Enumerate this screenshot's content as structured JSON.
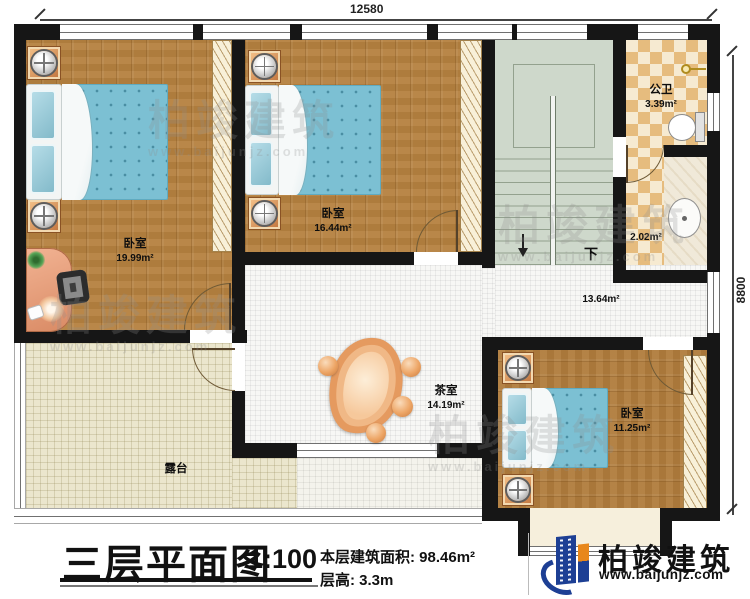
{
  "plan": {
    "dimensions": {
      "width_label": "12580",
      "height_label": "8800"
    },
    "rooms": {
      "bedroom1": {
        "name": "卧室",
        "area": "19.99m²"
      },
      "bedroom2": {
        "name": "卧室",
        "area": "16.44m²"
      },
      "bedroom3": {
        "name": "卧室",
        "area": "11.25m²"
      },
      "bathroom": {
        "name": "公卫",
        "area": "3.39m²"
      },
      "washroom": {
        "area": "2.02m²"
      },
      "hall": {
        "area": "13.64m²"
      },
      "tearoom": {
        "name": "茶室",
        "area": "14.19m²"
      },
      "terrace": {
        "name": "露台"
      },
      "stairs": {
        "down_label": "下"
      }
    }
  },
  "title_block": {
    "title": "三层平面图",
    "scale": "1:100",
    "floor_area_label": "本层建筑面积: 98.46m²",
    "floor_height_label": "层高: 3.3m"
  },
  "logo": {
    "company": "柏竣建筑",
    "website": "www.baijunjz.com"
  },
  "watermark": {
    "company": "柏竣建筑",
    "website": "www.baijunjz.com"
  },
  "colors": {
    "wall": "#161616",
    "wood": "#b5813f",
    "bed_blue": "#7cc0d3",
    "stairs_green": "#ced8cb",
    "bath_checker": "#e6bc7e",
    "terrace_cream": "#ebe6cd",
    "table_orange": "#e59a5f",
    "logo_blue": "#1d3f94",
    "logo_orange": "#e8871b"
  }
}
